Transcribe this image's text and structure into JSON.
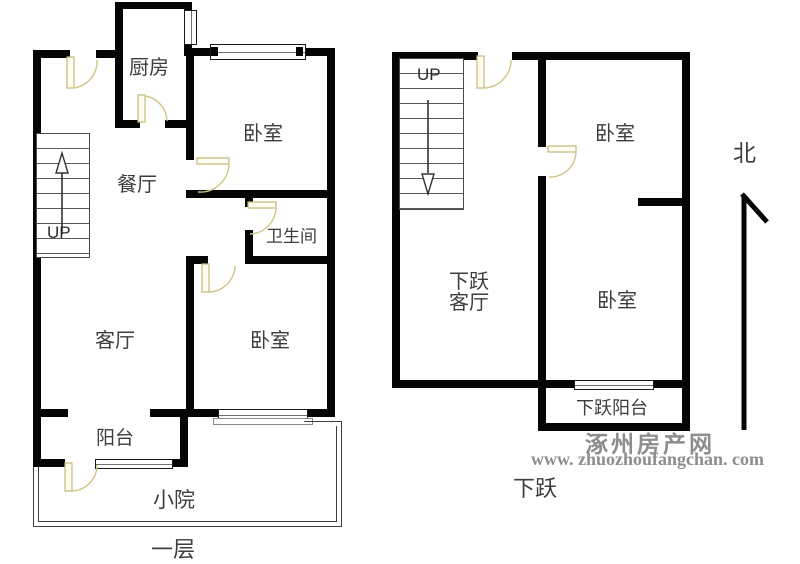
{
  "plans": {
    "first_floor": {
      "label": "一层",
      "kitchen": "厨房",
      "bedroom_top": "卧室",
      "dining": "餐厅",
      "stairs": "UP",
      "bathroom": "卫生间",
      "living": "客厅",
      "bedroom_bottom": "卧室",
      "balcony": "阳台",
      "yard": "小院"
    },
    "lower_floor": {
      "label": "下跃",
      "stairs": "UP",
      "bedroom_top": "卧室",
      "living_line1": "下跃",
      "living_line2": "客厅",
      "bedroom_bottom": "卧室",
      "balcony": "下跃阳台"
    }
  },
  "compass": {
    "north": "北"
  },
  "watermark": {
    "name": "涿州房产网",
    "url": "www. zhuozhoufangchan. com"
  },
  "colors": {
    "wall": "#050505",
    "door": "#c6ba7a",
    "watermark": "#8d8d8d"
  }
}
